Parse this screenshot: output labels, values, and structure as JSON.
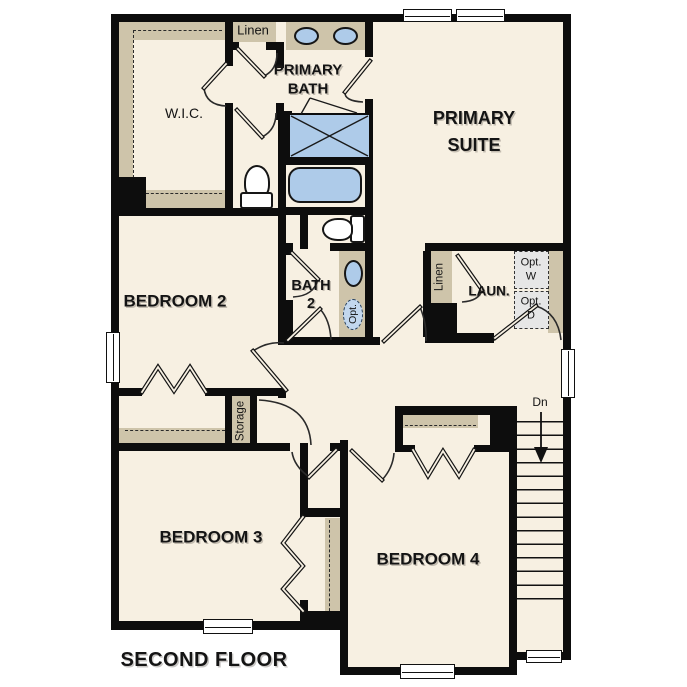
{
  "labels": {
    "linen_top": "Linen",
    "primary_bath_1": "PRIMARY",
    "primary_bath_2": "BATH",
    "wic": "W.I.C.",
    "primary_suite_1": "PRIMARY",
    "primary_suite_2": "SUITE",
    "bedroom2": "BEDROOM 2",
    "bath2_1": "BATH",
    "bath2_2": "2",
    "opt_sink": "Opt.",
    "linen_laundry": "Linen",
    "laundry": "LAUN.",
    "opt_w_1": "Opt.",
    "opt_w_2": "W",
    "opt_d_1": "Opt.",
    "opt_d_2": "D",
    "storage": "Storage",
    "stairs_down": "Dn",
    "bedroom3": "BEDROOM 3",
    "bedroom4": "BEDROOM 4",
    "floor_title": "SECOND FLOOR"
  },
  "colors": {
    "wall": "#0d0d0d",
    "floor": "#f7f0e2",
    "casework_tan": "#cec4aa",
    "fixture_blue": "#aecbe9",
    "appliance_gray": "#e6e6e6",
    "page_bg": "#ffffff"
  }
}
